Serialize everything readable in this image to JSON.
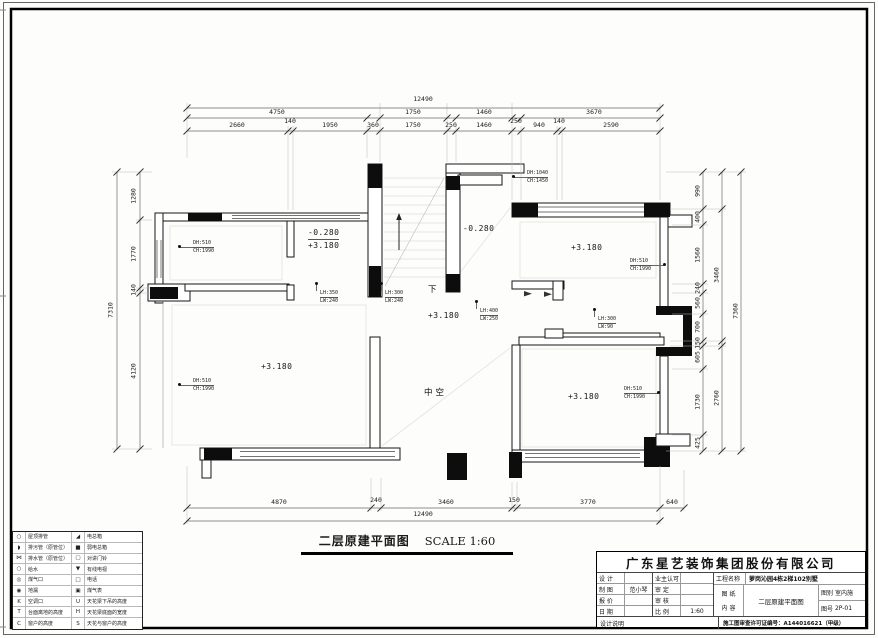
{
  "caption": {
    "title": "二层原建平面图",
    "scale": "SCALE 1:60"
  },
  "dims": {
    "top": [
      {
        "v": "12490",
        "x": 423,
        "y": 96
      },
      {
        "v": "4750",
        "x": 277,
        "y": 109
      },
      {
        "v": "1750",
        "x": 413,
        "y": 109
      },
      {
        "v": "1460",
        "x": 484,
        "y": 109
      },
      {
        "v": "3670",
        "x": 594,
        "y": 109
      },
      {
        "v": "2660",
        "x": 237,
        "y": 122
      },
      {
        "v": "140",
        "x": 290,
        "y": 118
      },
      {
        "v": "1950",
        "x": 330,
        "y": 122
      },
      {
        "v": "360",
        "x": 373,
        "y": 122
      },
      {
        "v": "1750",
        "x": 413,
        "y": 122
      },
      {
        "v": "250",
        "x": 451,
        "y": 122
      },
      {
        "v": "1460",
        "x": 484,
        "y": 122
      },
      {
        "v": "250",
        "x": 516,
        "y": 118
      },
      {
        "v": "940",
        "x": 539,
        "y": 122
      },
      {
        "v": "140",
        "x": 559,
        "y": 118
      },
      {
        "v": "2590",
        "x": 611,
        "y": 122
      }
    ],
    "bottom": [
      {
        "v": "4870",
        "x": 279,
        "y": 499
      },
      {
        "v": "240",
        "x": 376,
        "y": 497
      },
      {
        "v": "3460",
        "x": 446,
        "y": 499
      },
      {
        "v": "150",
        "x": 514,
        "y": 497
      },
      {
        "v": "3770",
        "x": 588,
        "y": 499
      },
      {
        "v": "640",
        "x": 672,
        "y": 499
      },
      {
        "v": "12490",
        "x": 423,
        "y": 511
      }
    ],
    "left": [
      {
        "v": "1280",
        "x": 134,
        "y": 196
      },
      {
        "v": "1770",
        "x": 134,
        "y": 254
      },
      {
        "v": "140",
        "x": 134,
        "y": 290
      },
      {
        "v": "4120",
        "x": 134,
        "y": 371
      },
      {
        "v": "7310",
        "x": 111,
        "y": 310
      }
    ],
    "right": [
      {
        "v": "990",
        "x": 698,
        "y": 191
      },
      {
        "v": "400",
        "x": 698,
        "y": 217
      },
      {
        "v": "1560",
        "x": 698,
        "y": 255
      },
      {
        "v": "240",
        "x": 698,
        "y": 288
      },
      {
        "v": "560",
        "x": 698,
        "y": 303
      },
      {
        "v": "700",
        "x": 698,
        "y": 327
      },
      {
        "v": "150",
        "x": 698,
        "y": 343
      },
      {
        "v": "605",
        "x": 698,
        "y": 357
      },
      {
        "v": "1730",
        "x": 698,
        "y": 402
      },
      {
        "v": "425",
        "x": 698,
        "y": 443
      },
      {
        "v": "3460",
        "x": 717,
        "y": 275
      },
      {
        "v": "2760",
        "x": 717,
        "y": 398
      },
      {
        "v": "7360",
        "x": 736,
        "y": 311
      }
    ]
  },
  "annotations": {
    "pairs": [
      {
        "l1": "DH:510",
        "l2": "CH:1990",
        "x": 193,
        "y": 240,
        "cls": "dot-l"
      },
      {
        "l1": "DH:1040",
        "l2": "CH:1450",
        "x": 527,
        "y": 170,
        "cls": "dot-l"
      },
      {
        "l1": "DH:510",
        "l2": "CH:1990",
        "x": 630,
        "y": 258,
        "cls": "dot-r"
      },
      {
        "l1": "DH:510",
        "l2": "CH:1990",
        "x": 193,
        "y": 378,
        "cls": "dot-l"
      },
      {
        "l1": "DH:510",
        "l2": "CH:1990",
        "x": 624,
        "y": 386,
        "cls": "dot-r"
      },
      {
        "l1": "LH:350",
        "l2": "LW:240",
        "x": 320,
        "y": 290,
        "cls": "dot-t"
      },
      {
        "l1": "LH:300",
        "l2": "LW:240",
        "x": 385,
        "y": 290,
        "cls": "dot-t"
      },
      {
        "l1": "LH:400",
        "l2": "LW:250",
        "x": 480,
        "y": 308,
        "cls": "dot-t"
      },
      {
        "l1": "LH:300",
        "l2": "LW:90",
        "x": 598,
        "y": 316,
        "cls": "dot-t"
      }
    ],
    "levels": [
      {
        "v": "-0.280",
        "v2": "+3.180",
        "x": 308,
        "y": 228
      },
      {
        "v": "-0.280",
        "x": 463,
        "y": 224
      },
      {
        "v": "+3.180",
        "x": 571,
        "y": 243
      },
      {
        "v": "+3.180",
        "x": 428,
        "y": 311
      },
      {
        "v": "+3.180",
        "x": 261,
        "y": 362
      },
      {
        "v": "+3.180",
        "x": 568,
        "y": 392
      }
    ],
    "texts": [
      {
        "v": "下",
        "x": 428,
        "y": 286
      },
      {
        "v": "中空",
        "x": 424,
        "y": 389
      }
    ]
  },
  "legend": {
    "rows": [
      {
        "s1": "○",
        "l1": "屋顶排管",
        "s2": "◢",
        "l2": "电总箱"
      },
      {
        "s1": "◗",
        "l1": "排污管（原管位）",
        "s2": "■",
        "l2": "弱电总箱"
      },
      {
        "s1": "⋈",
        "l1": "排水管（原管位）",
        "s2": "▢",
        "l2": "对讲门铃"
      },
      {
        "s1": "○",
        "l1": "给水",
        "s2": "▼",
        "l2": "有线电视"
      },
      {
        "s1": "◎",
        "l1": "煤气口",
        "s2": "□",
        "l2": "电话"
      },
      {
        "s1": "◉",
        "l1": "地漏",
        "s2": "▣",
        "l2": "煤气表"
      },
      {
        "s1": "K",
        "l1": "空调口",
        "s2": "U",
        "l2": "天花梁下吊的高度"
      },
      {
        "s1": "T",
        "l1": "台面离地的高度",
        "s2": "H",
        "l2": "天花梁底面的宽度"
      },
      {
        "s1": "C",
        "l1": "窗户的高度",
        "s2": "S",
        "l2": "天花与窗户的高度"
      }
    ]
  },
  "titleblock": {
    "company": "广东星艺装饰集团股份有限公司",
    "rows": [
      {
        "l1": "设 计",
        "v1": "",
        "l2": "业主认可",
        "v2": ""
      },
      {
        "l1": "制 图",
        "v1": "范小琴",
        "l2": "审 定",
        "v2": ""
      },
      {
        "l1": "报 价",
        "v1": "",
        "l2": "审 核",
        "v2": ""
      },
      {
        "l1": "日 期",
        "v1": "",
        "l2": "比 例",
        "v2": "1:60"
      }
    ],
    "project_label": "工程名称",
    "project": "萝岗沁园4栋2梯102别墅",
    "sheet_label_a": "图 纸",
    "sheet_label_b": "内 容",
    "content": "二层原建平面图",
    "class_label": "图别",
    "class_value": "室内施",
    "no_label": "图号",
    "no_value": "2P-01",
    "note": "设计说明",
    "permit": "施工图审查许可证编号：A144016621（甲级）"
  }
}
